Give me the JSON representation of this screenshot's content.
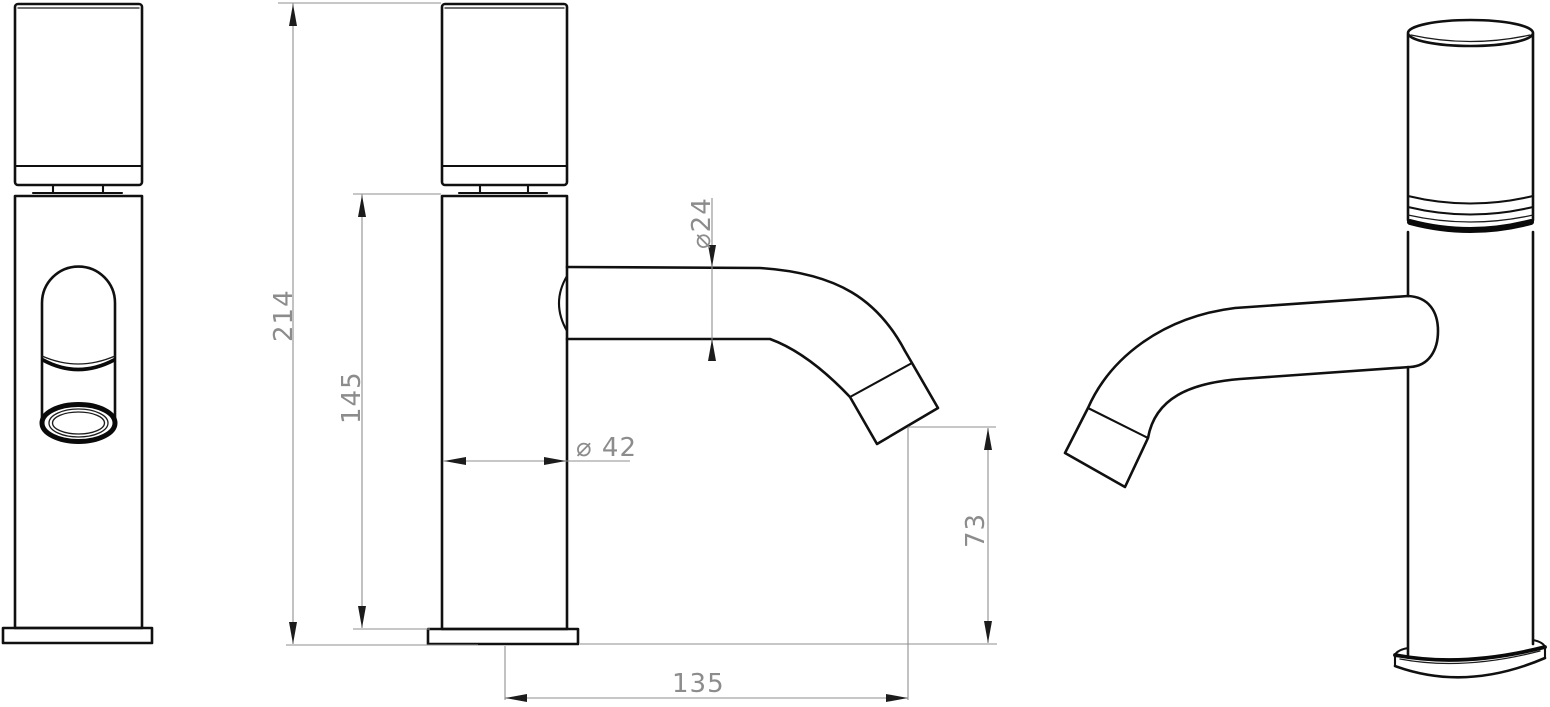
{
  "drawing": {
    "kind": "technical-drawing",
    "subject": "single-control basin tap faucet, three orthographic/perspective views",
    "background_color": "#ffffff",
    "outline_color": "#101010",
    "dimension_color": "#8f8f8f",
    "arrow_color": "#1c1c1c"
  },
  "views": {
    "front": {
      "name": "front view (spout facing viewer)"
    },
    "side": {
      "name": "side view with dimensions"
    },
    "perspective": {
      "name": "perspective view (spout left)"
    }
  },
  "dims": {
    "overall_height": {
      "label": "214",
      "orientation": "vertical"
    },
    "body_height": {
      "label": "145",
      "orientation": "vertical"
    },
    "spout_diameter": {
      "label": "⌀24",
      "orientation": "vertical"
    },
    "body_diameter": {
      "label": "⌀ 42",
      "orientation": "horizontal"
    },
    "tip_height": {
      "label": "73",
      "orientation": "vertical"
    },
    "spout_reach": {
      "label": "135",
      "orientation": "horizontal"
    }
  }
}
